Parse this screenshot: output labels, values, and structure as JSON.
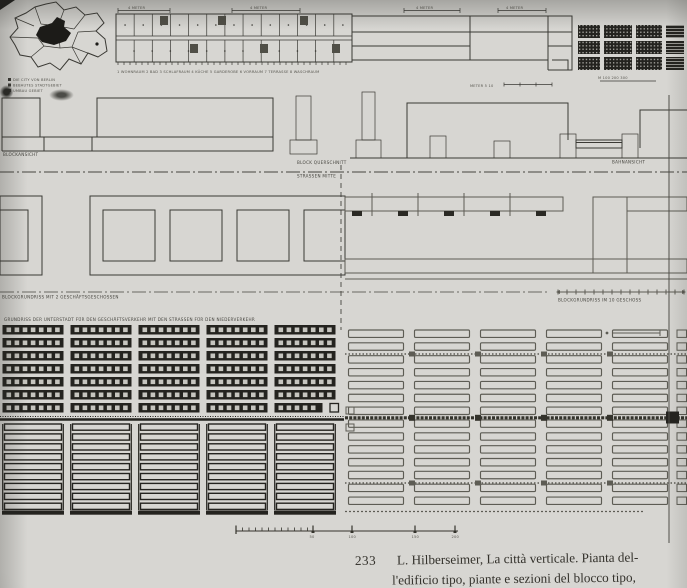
{
  "colors": {
    "paper": "#d7d6d2",
    "ink": "#3a3934",
    "ink2": "#5d5c54",
    "ink_dark": "#24231f"
  },
  "caption": {
    "number": "233",
    "line1": "L. Hilberseimer, La città verticale. Pianta del-",
    "line2": "l'edificio tipo, piante e sezioni del blocco tipo,"
  },
  "labels": {
    "map_legend": [
      "DIE CITY VON BERLIN",
      "BEBAUTES STADTGEBIET",
      "UMBAU GEBIET"
    ],
    "top_dims": [
      "4 METER",
      "4 METER",
      "4 METER",
      "4 METER"
    ],
    "top_legend": "1 WOHNRAUM  2 BAD  3 SCHLAFRAUM  4 KÜCHE  5 GARDEROBE  6 VORRAUM  7 TERRASSE  8 WASCHRAUM",
    "top_scale": "METER      5      10",
    "site_scale": "M  100  200  300",
    "sections": {
      "left": "BLOCKANSICHT",
      "center": "BLOCK QUERSCHNITT",
      "axis": "STRASSEN MITTE",
      "right": "BAHNANSICHT"
    },
    "mid": {
      "left": "BLOCKGRUNDRISS MIT 2 GESCHÄFTSGESCHOSSEN",
      "right": "BLOCKGRUNDRISS IM 10 GESCHOSS"
    },
    "lower_title": "GRUNDRISS DER UNTERSTADT FÜR DEN GESCHÄFTSVERKEHR MIT DEN STRASSEN FÜR DEN NIEDERVERKEHR"
  },
  "bottom_scale": {
    "labels": [
      "50",
      "100",
      "150",
      "200"
    ]
  },
  "grids": {
    "site_grid": {
      "rows": 3,
      "cols": 3,
      "striped_col": 1
    },
    "mid_courtyards": 4,
    "lower_left": {
      "columns": 5,
      "upper_rows": 7,
      "windows_per_bar": 7,
      "lower_rows": 9
    },
    "lower_right": {
      "columns": 5,
      "rows": 14
    }
  }
}
